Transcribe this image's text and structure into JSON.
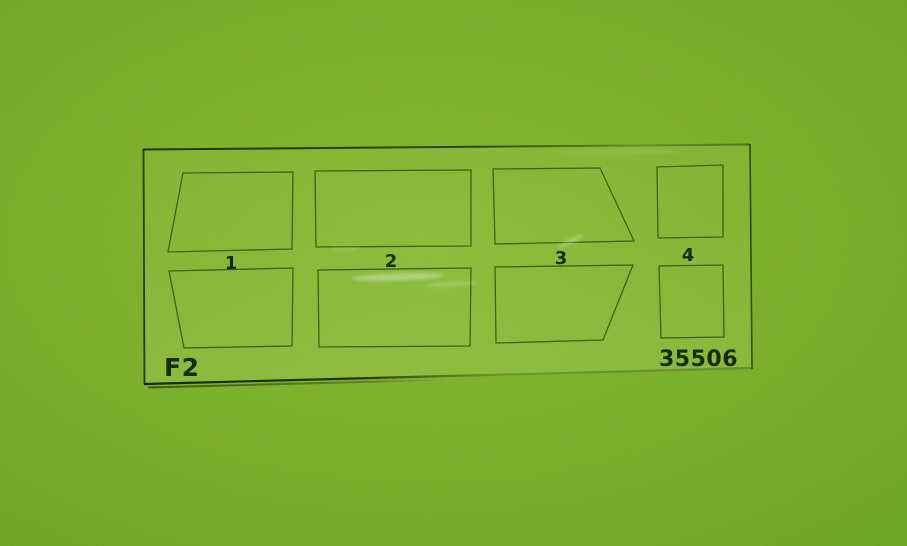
{
  "sheet": {
    "code": "F2",
    "kit_number": "35506",
    "cutout_labels": [
      "1",
      "2",
      "3",
      "4"
    ]
  },
  "colors": {
    "background_center": "#85ba31",
    "background_edge": "#5e9621",
    "sheet_outline": "#2e4d11",
    "label_text": "#162e08"
  }
}
